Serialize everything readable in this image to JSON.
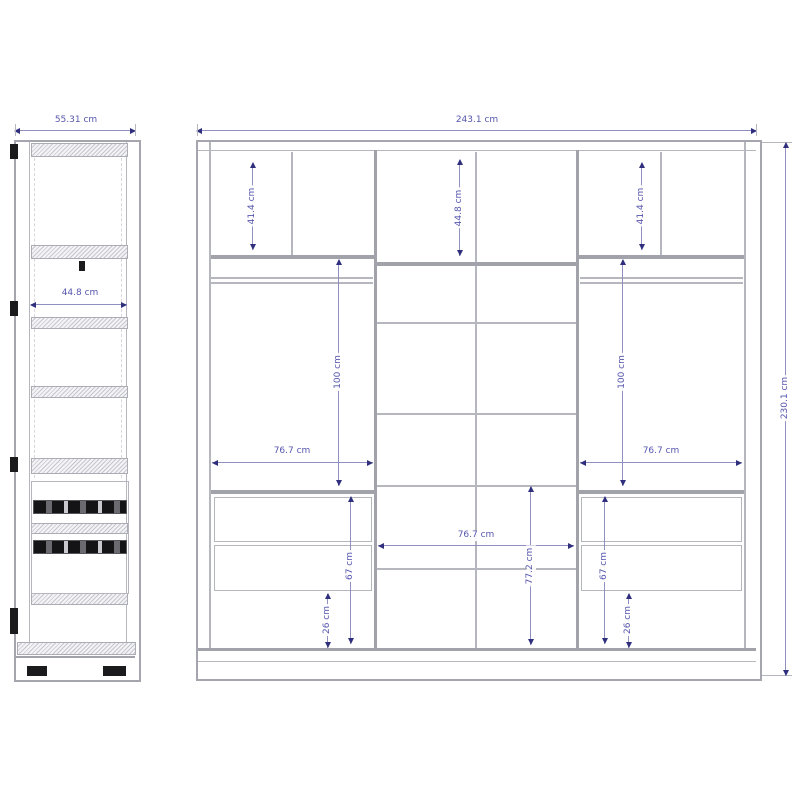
{
  "page": {
    "background": "#ffffff",
    "unit": "cm"
  },
  "colors": {
    "drawing_line": "#b6b6be",
    "drawing_line_dark": "#a2a2aa",
    "dimension_line": "#9090c0",
    "dimension_text": "#5656ae",
    "dimension_arrow": "#2f2f7e",
    "hardware_black": "#1b1b1e"
  },
  "side_view": {
    "name": "wardrobe side view",
    "dims": {
      "overall_width": "55.31 cm",
      "interior_depth": "44.8 cm"
    }
  },
  "front_view": {
    "name": "wardrobe front view",
    "dims": {
      "overall_width": "243.1 cm",
      "overall_height": "230.1 cm",
      "top_left": "41.4 cm",
      "top_middle": "44.8 cm",
      "top_right": "41.4 cm",
      "hang_left": "100 cm",
      "hang_right": "100 cm",
      "width_left": "76.7 cm",
      "width_middle": "76.7 cm",
      "width_right": "76.7 cm",
      "mid_lower_height": "77.2 cm",
      "drawer_left": "67 cm",
      "drawer_right": "67 cm",
      "base_left": "26 cm",
      "base_right": "26 cm"
    }
  }
}
